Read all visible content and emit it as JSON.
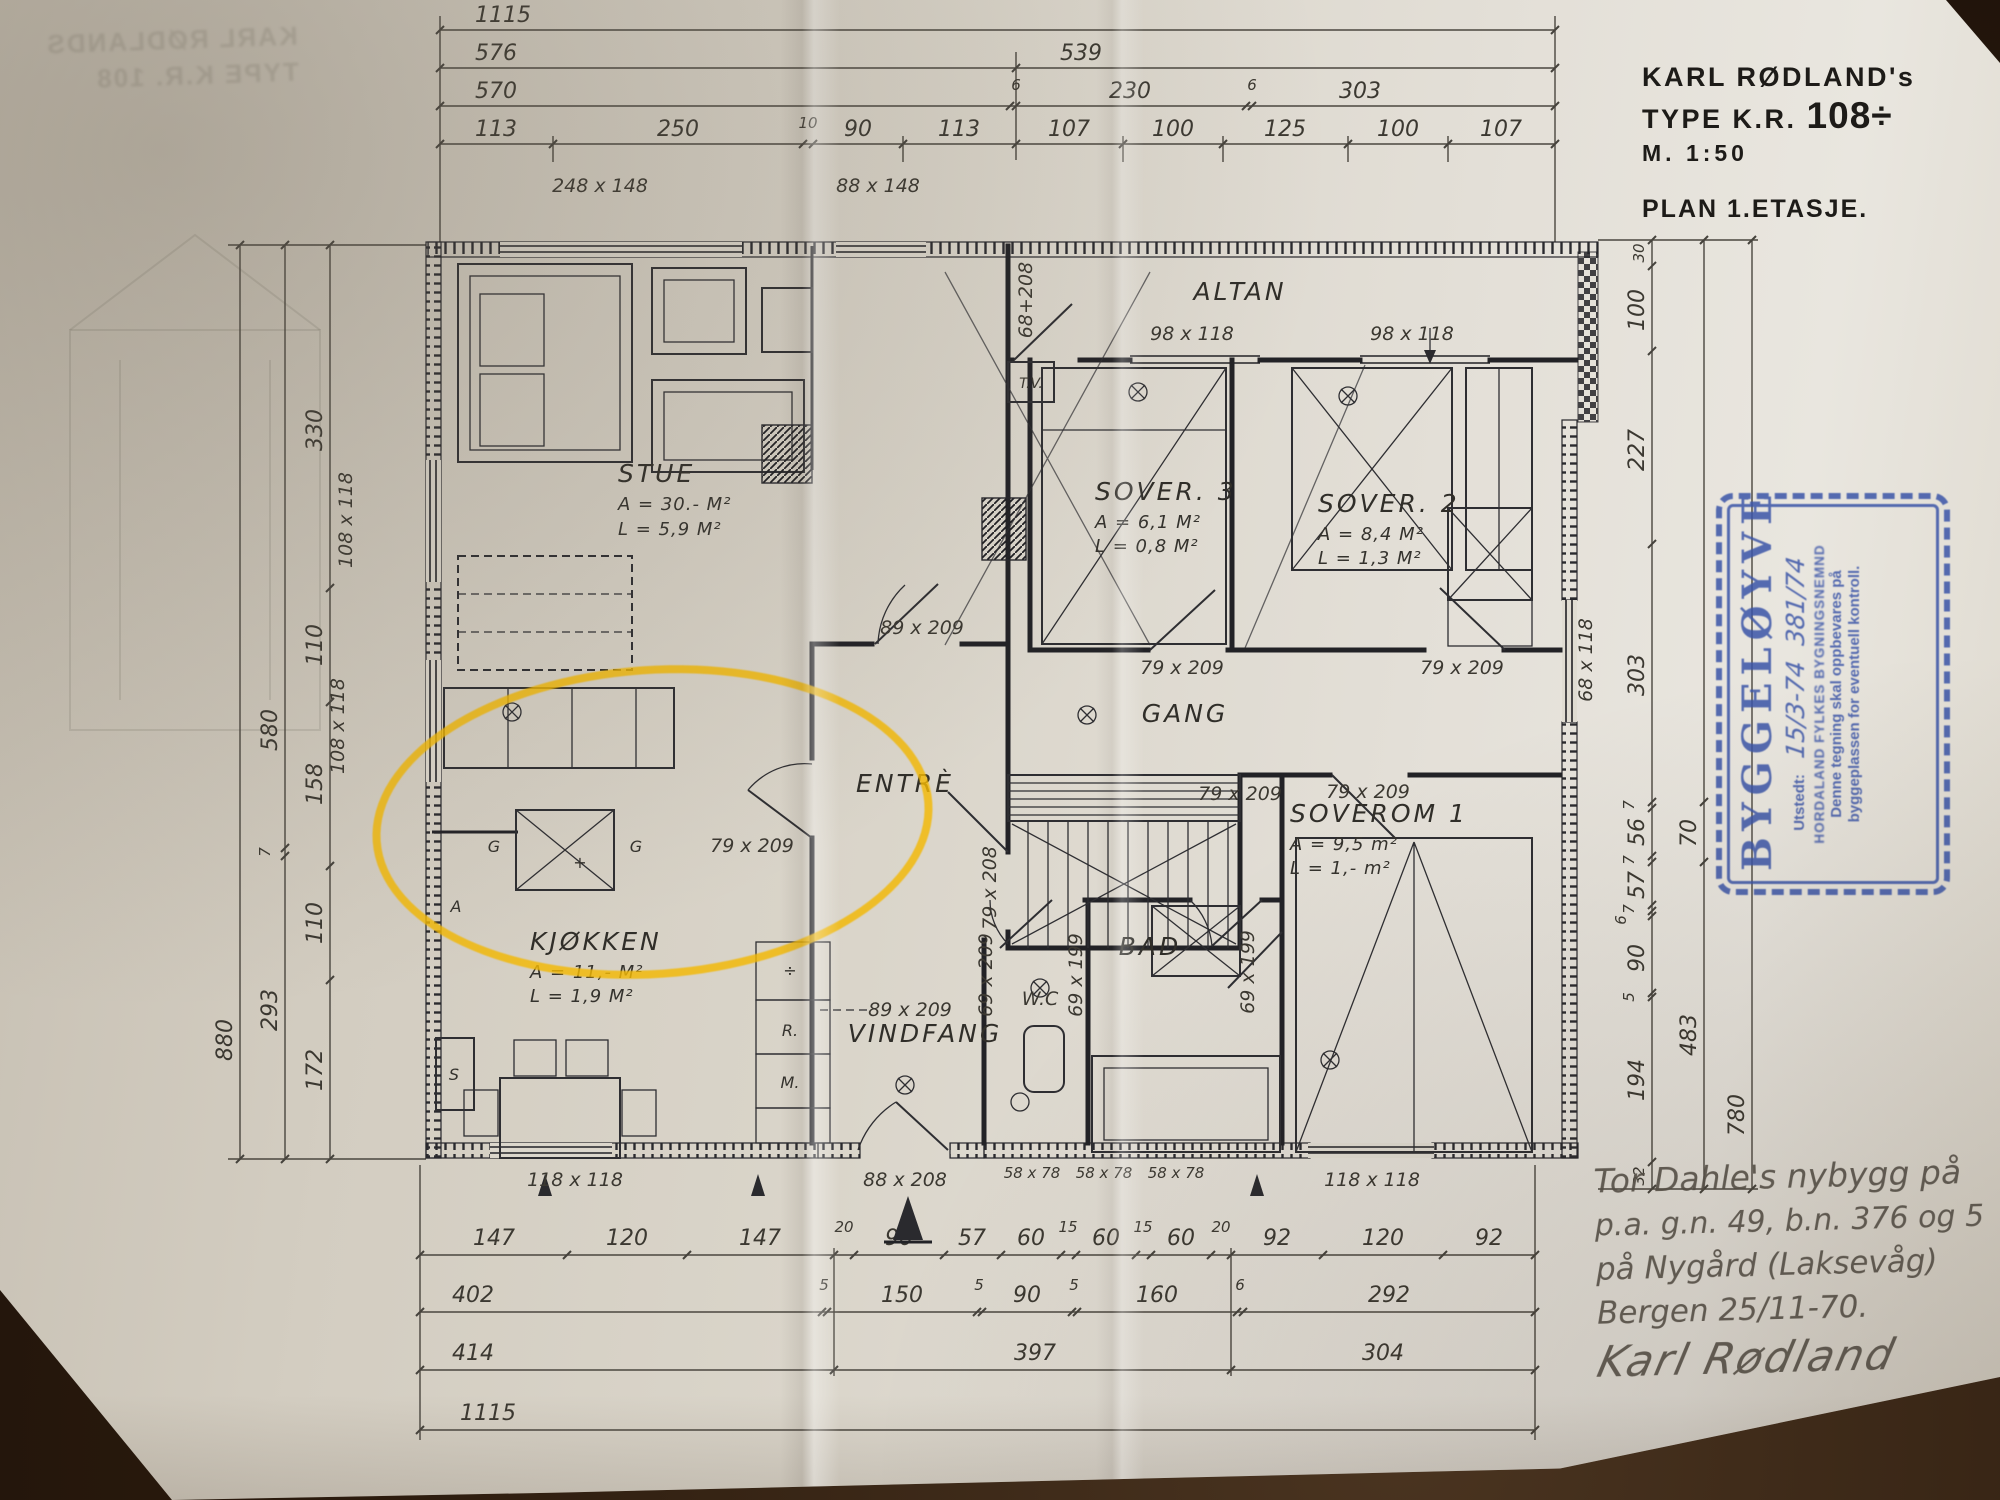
{
  "title_block": {
    "name": "KARL RØDLAND's",
    "type_prefix": "TYPE K.R.",
    "type_number": "108÷",
    "scale": "M. 1:50",
    "plan": "PLAN 1.ETASJE."
  },
  "rooms": {
    "stue": {
      "name": "STUE",
      "area": "A = 30.- M²",
      "load": "L = 5,9 M²"
    },
    "sover3": {
      "name": "SOVER. 3",
      "area": "A = 6,1 M²",
      "load": "L = 0,8 M²"
    },
    "sover2": {
      "name": "SOVER. 2",
      "area": "A = 8,4 M²",
      "load": "L = 1,3 M²"
    },
    "soverom1": {
      "name": "SOVEROM 1",
      "area": "A = 9,5 m²",
      "load": "L = 1,- m²"
    },
    "kjokken": {
      "name": "KJØKKEN",
      "area": "A = 11,- M²",
      "load": "L = 1,9 M²"
    },
    "altan": {
      "name": "ALTAN"
    },
    "gang": {
      "name": "GANG"
    },
    "entre": {
      "name": "ENTRÈ"
    },
    "wc": {
      "name": "W.C"
    },
    "bad": {
      "name": "BAD"
    },
    "vindfang": {
      "name": "VINDFANG"
    },
    "tv": {
      "name": "T.V."
    }
  },
  "windows": {
    "top1": "248 x 148",
    "top2": "88 x 148",
    "altan1": "98 x 118",
    "altan2": "98 x 118",
    "left1": "108 x 118",
    "left2": "108 x 118",
    "right1": "68 x 118",
    "bottom_left": "118 x 118",
    "bottom_right": "118 x 118",
    "cellar1": "58 x 78",
    "cellar2": "58 x 78",
    "cellar3": "58 x 78",
    "altan_door": "68+208"
  },
  "doors": {
    "entre": "89 x 209",
    "passage": "89 x 209",
    "kitchen": "79 x 209",
    "sover3": "79 x 209",
    "sover2": "79 x 209",
    "soverom1": "79 x 209",
    "soverom1b": "79 x 209",
    "stair": "79 x 208",
    "wc": "69 x 209",
    "bad": "69 x 199",
    "bad2": "69 x 199",
    "entry": "88 x 208"
  },
  "marks": {
    "g1": "G",
    "g2": "G",
    "plus": "+",
    "a": "A",
    "s": "S",
    "divide": "÷",
    "r": "R.",
    "m": "M."
  },
  "dims": {
    "top": {
      "r1": [
        "1115"
      ],
      "r2": [
        "576",
        "539"
      ],
      "r3": [
        "570",
        "6",
        "230",
        "6",
        "303"
      ],
      "r4": [
        "113",
        "250",
        "10",
        "90",
        "113",
        "107",
        "100",
        "125",
        "100",
        "107"
      ]
    },
    "bottom": {
      "r1": [
        "147",
        "120",
        "147",
        "20",
        "90",
        "57",
        "60",
        "15",
        "60",
        "15",
        "60",
        "20",
        "92",
        "120",
        "92"
      ],
      "r2": [
        "402",
        "5",
        "150",
        "5",
        "90",
        "5",
        "160",
        "6",
        "292"
      ],
      "r3": [
        "414",
        "397",
        "304"
      ],
      "r4": [
        "1115"
      ]
    },
    "left": {
      "inner": [
        "330",
        "110",
        "158",
        "110",
        "172"
      ],
      "mid": [
        "580",
        "7",
        "293"
      ],
      "outer": [
        "880"
      ]
    },
    "right": {
      "inner": [
        "30",
        "100",
        "227",
        "303",
        "7",
        "56",
        "7",
        "57",
        "7",
        "6",
        "90",
        "5",
        "194",
        "32"
      ],
      "mid": [
        "70",
        "483"
      ],
      "outer": [
        "780"
      ]
    }
  },
  "stamp": {
    "title": "BYGGELØYVE",
    "issued_label": "Utstedt:",
    "issued_value": "15/3-74",
    "case_number": "381/74",
    "authority": "HORDALAND FYLKES BYGNINGSNEMND",
    "note1": "Denne tegning skal oppbevares på",
    "note2": "byggeplassen for eventuell kontroll.",
    "color": "#3b55a8"
  },
  "note": {
    "l1": "Tor Dahle's nybygg på",
    "l2": "p.a. g.n. 49, b.n. 376 og 5",
    "l3": "på Nygård (Laksevåg)",
    "l4": "Bergen 25/11-70.",
    "l5": "Karl Rødland"
  },
  "highlight": {
    "color": "#f1b402"
  },
  "ghost": {
    "l1": "KARL RØDLANDS",
    "l2": "TYPE K.R. 108"
  }
}
